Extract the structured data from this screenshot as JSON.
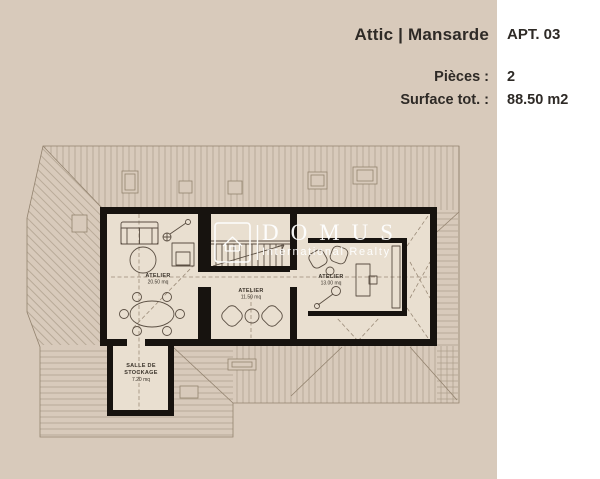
{
  "header": {
    "title": "Attic | Mansarde",
    "apartment": "APT. 03",
    "rows": [
      {
        "label": "Pièces :",
        "value": "2"
      },
      {
        "label": "Surface tot. :",
        "value": "88.50 m2"
      }
    ]
  },
  "watermark": {
    "brand": "DOMUS",
    "tagline": "International Realty",
    "logo_icon": "house-in-rounded-square-icon"
  },
  "rooms": [
    {
      "name": "ATELIER",
      "area": "20.50 mq"
    },
    {
      "name": "ATELIER",
      "area": "11.50 mq"
    },
    {
      "name": "ATELIER",
      "area": "13.00 mq"
    },
    {
      "name": "SALLE DE STOCKAGE",
      "area": "7.20 mq"
    }
  ],
  "colors": {
    "bg": "#d8cabb",
    "panel": "#ffffff",
    "ink": "#2e2a26",
    "ink2": "#3c352c",
    "wall": "#17130f",
    "line": "#5a4e42",
    "roof": "#ab9c89",
    "roofedge": "#93836f",
    "dash": "#9b8b78",
    "floor": "#e9dfd0",
    "wm": "#ffffff"
  }
}
